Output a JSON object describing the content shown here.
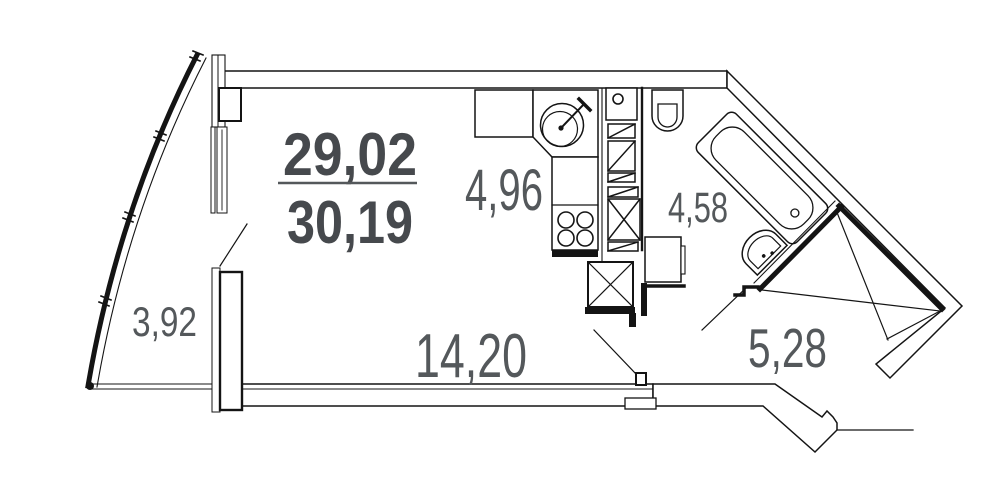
{
  "plan": {
    "areas": {
      "upper": "29,02",
      "lower": "30,19"
    },
    "rooms": {
      "kitchen": "4,96",
      "bathroom": "4,58",
      "balcony": "3,92",
      "living": "14,20",
      "hall": "5,28"
    },
    "colors": {
      "label": "#54585b",
      "label_bold": "#46494d",
      "line": "#141414"
    }
  }
}
